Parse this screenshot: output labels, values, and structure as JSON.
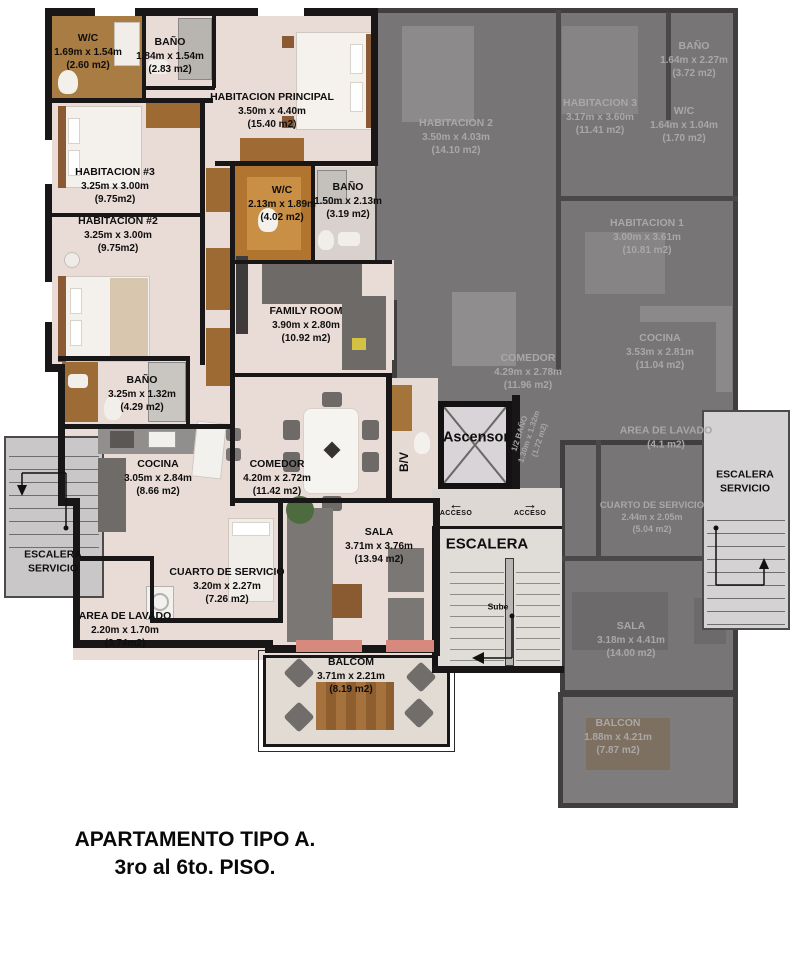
{
  "title": {
    "line1": "APARTAMENTO TIPO A.",
    "line2": "3ro al 6to. PISO."
  },
  "core": {
    "ascensor": "Ascensor",
    "escalera": "ESCALERA",
    "sube": "Sube",
    "acceso_left": "ACCESO",
    "acceso_right": "ACCESO",
    "arrow_left": "←",
    "arrow_right": "→",
    "bv": "B/V",
    "service_stair_left": {
      "line1": "ESCALERA",
      "line2": "SERVICIO"
    },
    "service_stair_right": {
      "line1": "ESCALERA",
      "line2": "SERVICIO"
    }
  },
  "apartment_a": {
    "rooms": [
      {
        "name": "W/C",
        "dims": "1.69m x 1.54m",
        "area": "(2.60 m2)"
      },
      {
        "name": "BAÑO",
        "dims": "1.84m x 1.54m",
        "area": "(2.83 m2)"
      },
      {
        "name": "HABITACION PRINCIPAL",
        "dims": "3.50m x 4.40m",
        "area": "(15.40 m2)"
      },
      {
        "name": "HABITACION #3",
        "dims": "3.25m x 3.00m",
        "area": "(9.75m2)"
      },
      {
        "name": "HABITACION #2",
        "dims": "3.25m x 3.00m",
        "area": "(9.75m2)"
      },
      {
        "name": "W/C",
        "dims": "2.13m x 1.89m",
        "area": "(4.02 m2)"
      },
      {
        "name": "BAÑO",
        "dims": "1.50m x 2.13m",
        "area": "(3.19 m2)"
      },
      {
        "name": "FAMILY ROOM",
        "dims": "3.90m x 2.80m",
        "area": "(10.92 m2)"
      },
      {
        "name": "BAÑO",
        "dims": "3.25m x 1.32m",
        "area": "(4.29 m2)"
      },
      {
        "name": "COCINA",
        "dims": "3.05m x 2.84m",
        "area": "(8.66 m2)"
      },
      {
        "name": "COMEDOR",
        "dims": "4.20m x 2.72m",
        "area": "(11.42 m2)"
      },
      {
        "name": "SALA",
        "dims": "3.71m x 3.76m",
        "area": "(13.94 m2)"
      },
      {
        "name": "CUARTO DE SERVICIO",
        "dims": "3.20m x 2.27m",
        "area": "(7.26 m2)"
      },
      {
        "name": "AREA DE LAVADO",
        "dims": "2.20m x 1.70m",
        "area": "(3.74m2)"
      },
      {
        "name": "BALCOM",
        "dims": "3.71m x 2.21m",
        "area": "(8.19 m2)"
      }
    ]
  },
  "apartment_b": {
    "rooms": [
      {
        "name": "BAÑO",
        "dims": "1.64m x 2.27m",
        "area": "(3.72 m2)"
      },
      {
        "name": "HABITACION 2",
        "dims": "3.50m x 4.03m",
        "area": "(14.10 m2)"
      },
      {
        "name": "HABITACION 3",
        "dims": "3.17m x 3.60m",
        "area": "(11.41 m2)"
      },
      {
        "name": "W/C",
        "dims": "1.64m x 1.04m",
        "area": "(1.70 m2)"
      },
      {
        "name": "HABITACION 1",
        "dims": "3.00m x 3.61m",
        "area": "(10.81 m2)"
      },
      {
        "name": "COCINA",
        "dims": "3.53m x 2.81m",
        "area": "(11.04 m2)"
      },
      {
        "name": "COMEDOR",
        "dims": "4.29m x 2.78m",
        "area": "(11.96 m2)"
      },
      {
        "name": "1/2 BAÑO",
        "dims": "1.30m x 1.32m",
        "area": "(1.72 m2)"
      },
      {
        "name": "AREA DE LAVADO",
        "dims": "",
        "area": "(4.1 m2)"
      },
      {
        "name": "CUARTO DE SERVICIO",
        "dims": "2.44m x 2.05m",
        "area": "(5.04 m2)"
      },
      {
        "name": "SALA",
        "dims": "3.18m x 4.41m",
        "area": "(14.00 m2)"
      },
      {
        "name": "BALCON",
        "dims": "1.88m x 4.21m",
        "area": "(7.87 m2)"
      }
    ]
  },
  "colors": {
    "wall": "#191617",
    "floor": "#e9dcd7",
    "wood": "#a87c42",
    "gray_overlay": "#787576",
    "stair_light": "#d6d4d4",
    "plant": "#4d6b3e",
    "flowers": "#d8897e"
  }
}
